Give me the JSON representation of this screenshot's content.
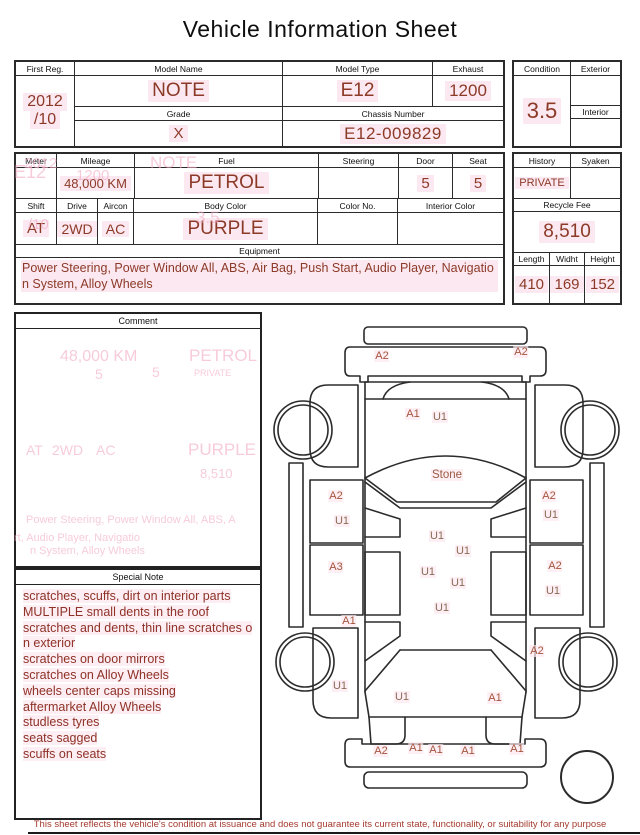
{
  "title": "Vehicle Information Sheet",
  "registration_table": {
    "first_reg": {
      "label": "First Reg.",
      "line1": "2012",
      "line2": "/10"
    },
    "model_name": {
      "label": "Model Name",
      "value": "NOTE"
    },
    "model_type": {
      "label": "Model Type",
      "value": "E12"
    },
    "exhaust": {
      "label": "Exhaust",
      "value": "1200"
    },
    "grade": {
      "label": "Grade",
      "value": "X"
    },
    "chassis_number": {
      "label": "Chassis Number",
      "value": "E12-009829"
    },
    "condition": {
      "label": "Condition",
      "value": "3.5"
    },
    "exterior": {
      "label": "Exterior",
      "value": ""
    },
    "interior": {
      "label": "Interior",
      "value": ""
    }
  },
  "spec_table": {
    "meter": {
      "label": "Meter",
      "value": ""
    },
    "mileage": {
      "label": "Mileage",
      "value": "48,000 KM"
    },
    "fuel": {
      "label": "Fuel",
      "value": "PETROL"
    },
    "steering": {
      "label": "Steering",
      "value": ""
    },
    "door": {
      "label": "Door",
      "value": "5"
    },
    "seat": {
      "label": "Seat",
      "value": "5"
    },
    "shift": {
      "label": "Shift",
      "value": "AT"
    },
    "drive": {
      "label": "Drive",
      "value": "2WD"
    },
    "aircon": {
      "label": "Aircon",
      "value": "AC"
    },
    "body_color": {
      "label": "Body Color",
      "value": "PURPLE"
    },
    "color_no": {
      "label": "Color No.",
      "value": ""
    },
    "interior_color": {
      "label": "Interior Color",
      "value": ""
    },
    "equipment": {
      "label": "Equipment",
      "value": "Power Steering, Power Window  All, ABS, Air Bag, Push Start, Audio Player, Navigation System, Alloy Wheels"
    },
    "history": {
      "label": "History",
      "value": "PRIVATE"
    },
    "syaken": {
      "label": "Syaken",
      "value": ""
    },
    "recycle_fee": {
      "label": "Recycle Fee",
      "value": "8,510"
    },
    "length": {
      "label": "Length",
      "value": "410"
    },
    "width": {
      "label": "Widht",
      "value": "169"
    },
    "height": {
      "label": "Height",
      "value": "152"
    }
  },
  "comment": {
    "label": "Comment",
    "value": ""
  },
  "special_note": {
    "label": "Special Note",
    "lines": [
      "scratches, scuffs, dirt on interior parts",
      "MULTIPLE small dents in the roof",
      "scratches and dents, thin line scratches on exterior",
      "scratches on door mirrors",
      "scratches on Alloy Wheels",
      "wheels center caps missing",
      "aftermarket Alloy Wheels",
      "studless tyres",
      "seats sagged",
      "scuffs on seats"
    ]
  },
  "diagram": {
    "labels": [
      {
        "text": "A2",
        "x": 112,
        "y": 41
      },
      {
        "text": "A2",
        "x": 251,
        "y": 37
      },
      {
        "text": "A1",
        "x": 143,
        "y": 99
      },
      {
        "text": "U1",
        "x": 170,
        "y": 102
      },
      {
        "text": "Stone",
        "x": 177,
        "y": 160
      },
      {
        "text": "A2",
        "x": 66,
        "y": 181
      },
      {
        "text": "U1",
        "x": 72,
        "y": 206
      },
      {
        "text": "A3",
        "x": 66,
        "y": 252
      },
      {
        "text": "A1",
        "x": 79,
        "y": 306
      },
      {
        "text": "U1",
        "x": 70,
        "y": 371
      },
      {
        "text": "A2",
        "x": 279,
        "y": 181
      },
      {
        "text": "U1",
        "x": 281,
        "y": 200
      },
      {
        "text": "A2",
        "x": 285,
        "y": 251
      },
      {
        "text": "U1",
        "x": 283,
        "y": 276
      },
      {
        "text": "A2",
        "x": 267,
        "y": 336
      },
      {
        "text": "U1",
        "x": 167,
        "y": 221
      },
      {
        "text": "U1",
        "x": 193,
        "y": 236
      },
      {
        "text": "U1",
        "x": 158,
        "y": 257
      },
      {
        "text": "U1",
        "x": 188,
        "y": 268
      },
      {
        "text": "U1",
        "x": 172,
        "y": 293
      },
      {
        "text": "U1",
        "x": 132,
        "y": 382
      },
      {
        "text": "A1",
        "x": 225,
        "y": 383
      },
      {
        "text": "A2",
        "x": 111,
        "y": 436
      },
      {
        "text": "A1",
        "x": 146,
        "y": 433
      },
      {
        "text": "A1",
        "x": 166,
        "y": 435
      },
      {
        "text": "A1",
        "x": 198,
        "y": 436
      },
      {
        "text": "A1",
        "x": 247,
        "y": 434
      }
    ]
  },
  "ghost_text": [
    {
      "text": "E12",
      "x": 14,
      "y": 162,
      "size": 18
    },
    {
      "text": "2012",
      "x": 24,
      "y": 155,
      "size": 15
    },
    {
      "text": "NOTE",
      "x": 150,
      "y": 153,
      "size": 17
    },
    {
      "text": "1200",
      "x": 76,
      "y": 167,
      "size": 15
    },
    {
      "text": "/10",
      "x": 28,
      "y": 216,
      "size": 15
    },
    {
      "text": "3.5",
      "x": 196,
      "y": 208,
      "size": 17
    },
    {
      "text": "48,000 KM",
      "x": 60,
      "y": 348,
      "size": 16
    },
    {
      "text": "5",
      "x": 95,
      "y": 366,
      "size": 14
    },
    {
      "text": "5",
      "x": 152,
      "y": 364,
      "size": 14
    },
    {
      "text": "PETROL",
      "x": 189,
      "y": 346,
      "size": 17
    },
    {
      "text": "PRIVATE",
      "x": 194,
      "y": 368,
      "size": 9
    },
    {
      "text": "AT",
      "x": 26,
      "y": 442,
      "size": 14
    },
    {
      "text": "2WD",
      "x": 52,
      "y": 442,
      "size": 14
    },
    {
      "text": "AC",
      "x": 96,
      "y": 442,
      "size": 14
    },
    {
      "text": "PURPLE",
      "x": 188,
      "y": 440,
      "size": 17
    },
    {
      "text": "8,510",
      "x": 200,
      "y": 466,
      "size": 13
    },
    {
      "text": "Power Steering, Power Window  All, ABS, A",
      "x": 26,
      "y": 514,
      "size": 11
    },
    {
      "text": "rt, Audio Player, Navigatio",
      "x": 14,
      "y": 532,
      "size": 11
    },
    {
      "text": "n System, Alloy Wheels",
      "x": 30,
      "y": 545,
      "size": 11
    }
  ],
  "footer": "This sheet reflects the vehicle's condition at issuance and does not guarantee its current state, functionality, or suitability for any purpose",
  "colors": {
    "value_text": "#8c3a28",
    "note_text": "#8e3126",
    "highlight_pink": "#fce8f0",
    "ghost_pink": "#f2a9c4",
    "line": "#2b2b2b",
    "damage_a_code": "#a4543c",
    "damage_u_code": "#8a6a55",
    "footer_text": "#a53a2e"
  }
}
